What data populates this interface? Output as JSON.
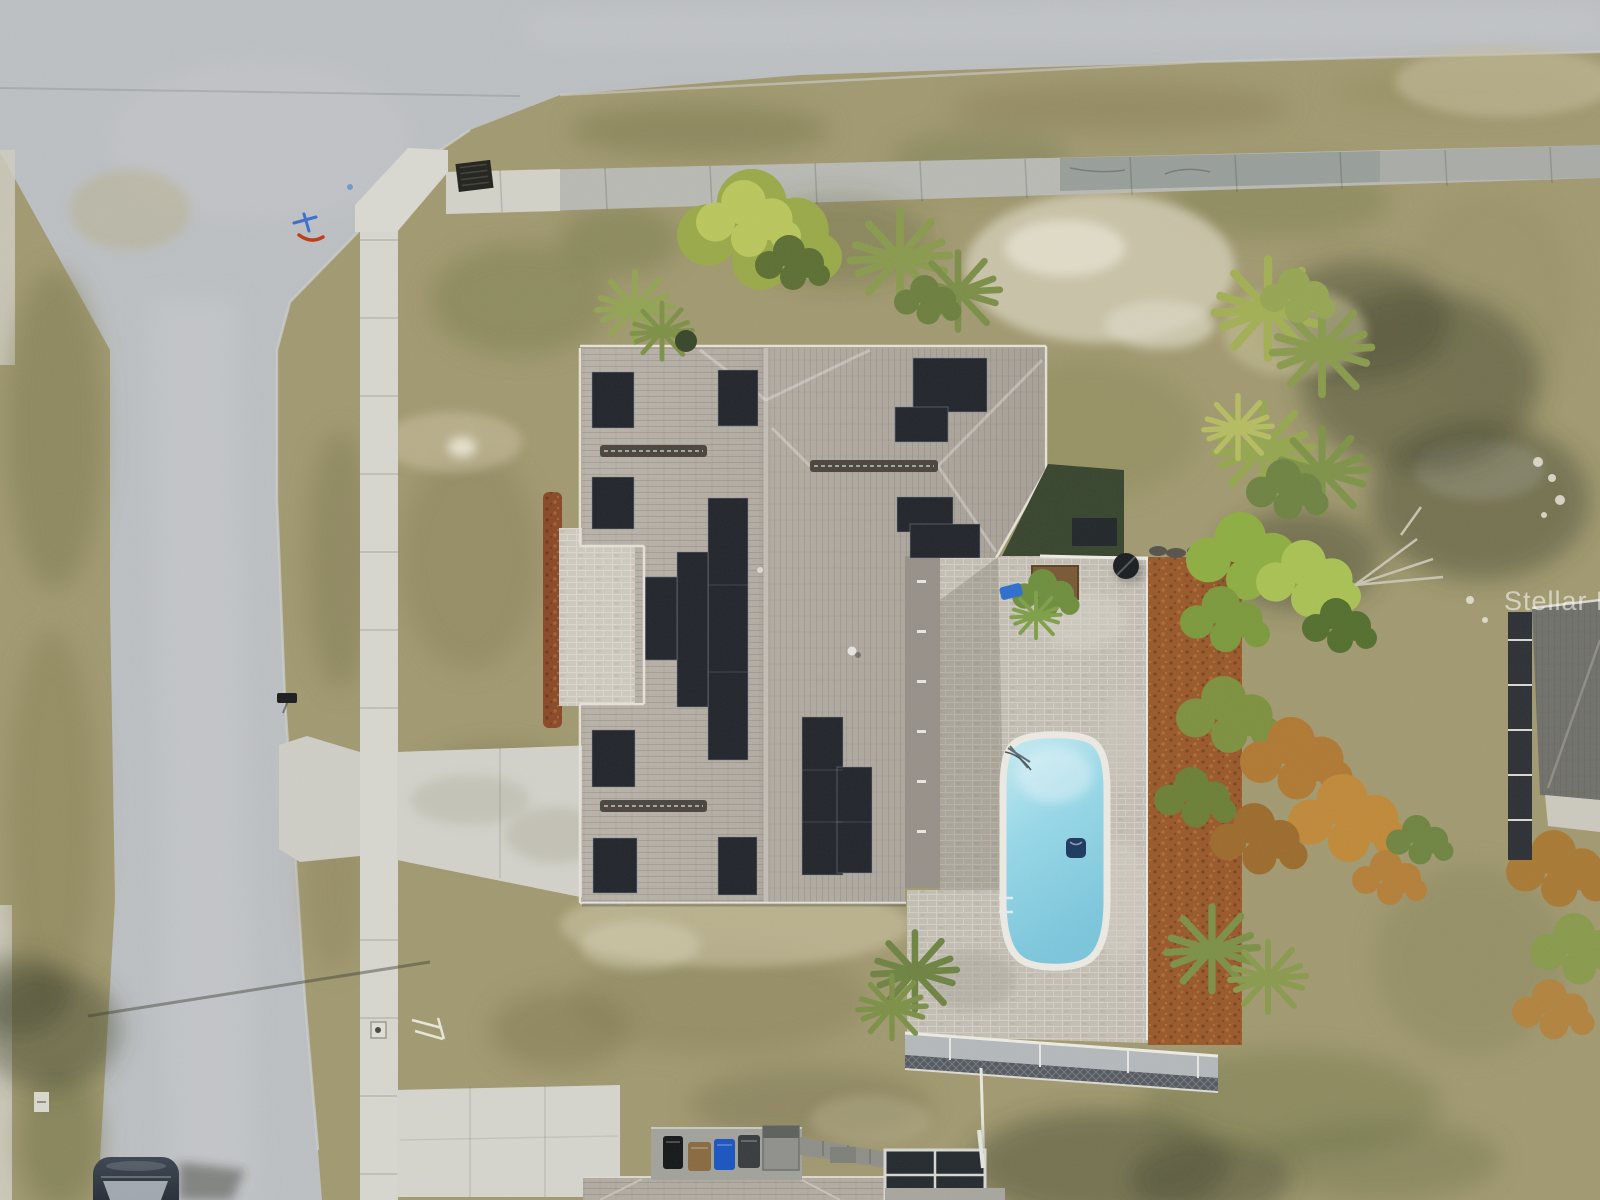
{
  "scene": {
    "type": "aerial-drone-photograph",
    "description": "Top-down aerial view of a corner-lot single-family home with rooftop solar panels, a screened swimming pool with paver deck, driveway, sidewalks, lawns and surrounding streets",
    "watermark": {
      "text": "Stellar MLS",
      "color": "#ffffff",
      "opacity": 0.55
    },
    "objects": [
      "street-intersection",
      "asphalt-road-left",
      "asphalt-road-top",
      "concrete-sidewalk-vertical",
      "concrete-sidewalk-horizontal-weathered",
      "curb-ramp",
      "storm-drain-grate",
      "utility-paint-marks",
      "mailbox",
      "driveway",
      "driveway-street-flare",
      "neighbor-parking-slab",
      "house-roof",
      "solar-panel-array",
      "ridge-vents",
      "roof-vent-pipes",
      "paver-patio-west",
      "mulch-bed-west",
      "pool-deck-pavers",
      "swimming-pool",
      "pool-handrail",
      "pool-float",
      "pool-steps",
      "screen-enclosure-south-wall",
      "screen-enclosure-frame",
      "mulch-bed-east",
      "gravel-row",
      "planter-box",
      "grill",
      "palm-trees",
      "shade-trees",
      "orange-foliage-tree",
      "dead-branches",
      "lawn-grass",
      "sand-patches",
      "tree-shadows",
      "light-pole-shadow",
      "trash-bin-black",
      "trash-bin-brown",
      "trash-bin-blue",
      "trash-bin-gray",
      "equipment-box",
      "utility-pad",
      "parked-car",
      "car-shadow",
      "neighbor-roof-east",
      "neighbor-screen-enclosure-east",
      "neighbor-roof-south",
      "neighbor-screen-enclosure-south",
      "utility-marker-sidewalk",
      "utility-marker-grass",
      "white-debris"
    ],
    "palette": {
      "asphalt": "#bdc0c3",
      "concrete_new": "#d6d5cd",
      "concrete_weathered": "#9fa39f",
      "roof_shingle": "#b3aba2",
      "solar_panel": "#23262c",
      "pool_water": "#8fd4e6",
      "pool_coping": "#eceae3",
      "paver_deck": "#c4bfb4",
      "mulch": "#9a5a2b",
      "grass_tan": "#a29a71",
      "grass_green": "#76804c",
      "sand_patch": "#d3cdb6",
      "tree_green": "#8fae43",
      "tree_orange": "#b07a33",
      "watermark_color": "#ffffff"
    }
  }
}
